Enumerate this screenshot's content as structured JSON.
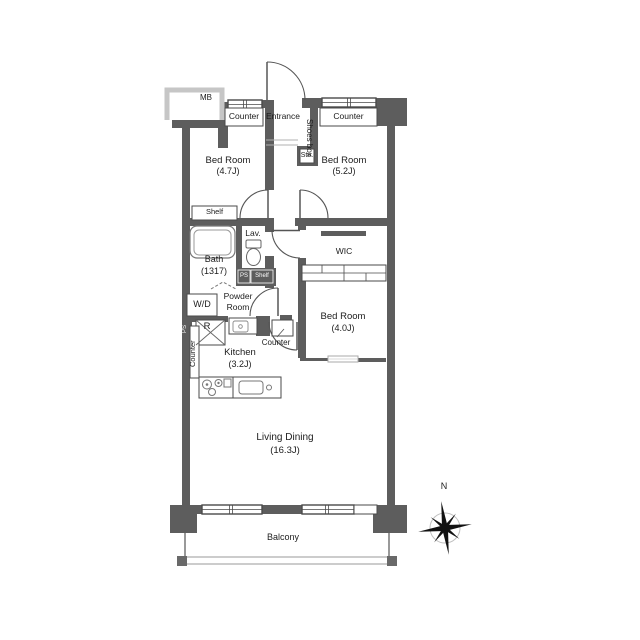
{
  "floorplan": {
    "rooms": {
      "bedroom1": {
        "name": "Bed Room",
        "size": "(4.7J)"
      },
      "bedroom2": {
        "name": "Bed Room",
        "size": "(5.2J)"
      },
      "bedroom3": {
        "name": "Bed Room",
        "size": "(4.0J)"
      },
      "living_dining": {
        "name": "Living Dining",
        "size": "(16.3J)"
      },
      "kitchen": {
        "name": "Kitchen",
        "size": "(3.2J)"
      },
      "bath": {
        "name": "Bath",
        "size": "(1317)"
      },
      "powder_room": {
        "line1": "Powder",
        "line2": "Room"
      },
      "lavatory": {
        "name": "Lav."
      },
      "wic": {
        "name": "WIC"
      },
      "entrance": {
        "name": "Entrance"
      },
      "balcony": {
        "name": "Balcony"
      }
    },
    "labels": {
      "meter_box": "MB",
      "counter_top_left": "Counter",
      "counter_top_right": "Counter",
      "counter_kitchen": "Counter",
      "counter_kitchen_wall": "Counter",
      "shoes_box": "Shoes box",
      "storage": "Sto.",
      "shelf_bedroom": "Shelf",
      "shelf_hall": "Shelf",
      "pipe_space_hall": "PS",
      "pipe_space_kitchen": "PS",
      "washer_dryer": "W/D",
      "refrigerator": "R"
    },
    "compass": {
      "north": "N"
    },
    "colors": {
      "wall": "#5d5d5d",
      "light_gray": "#c6c6c6",
      "outline": "#4a4a4a",
      "text": "#1c1c1c",
      "background": "#ffffff"
    }
  }
}
